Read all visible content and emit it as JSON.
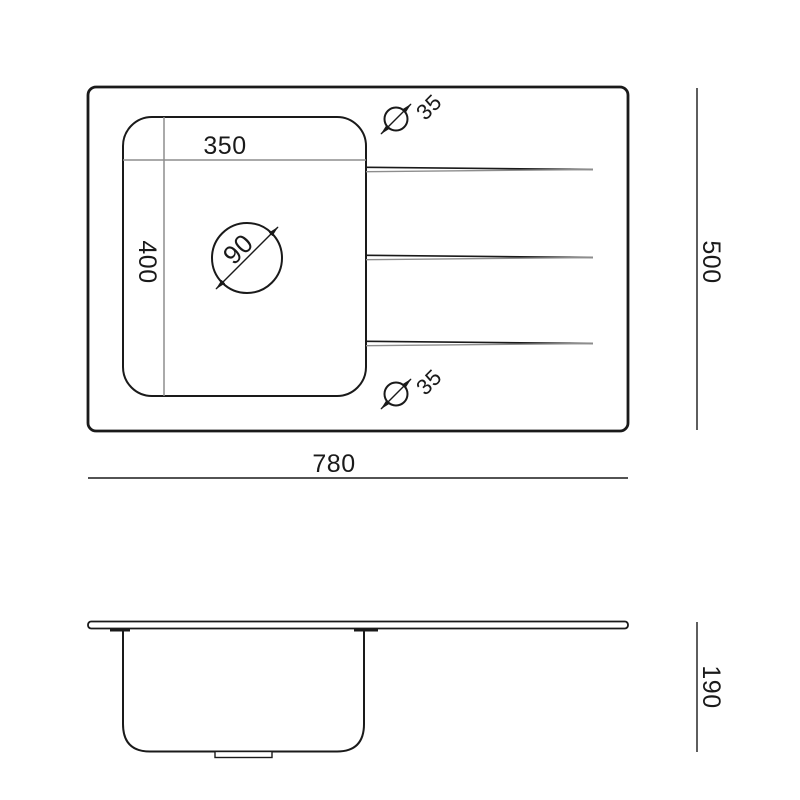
{
  "colors": {
    "line": "#1a1a1a",
    "dim_line": "#8d8d8d",
    "text": "#1a1a1a",
    "background": "#ffffff"
  },
  "top_view": {
    "overall_width": "780",
    "overall_depth": "500",
    "bowl_width": "350",
    "bowl_length": "400",
    "drain_diameter": "90",
    "tap_hole_top_diameter": "35",
    "tap_hole_bottom_diameter": "35"
  },
  "side_view": {
    "bowl_depth": "190"
  }
}
